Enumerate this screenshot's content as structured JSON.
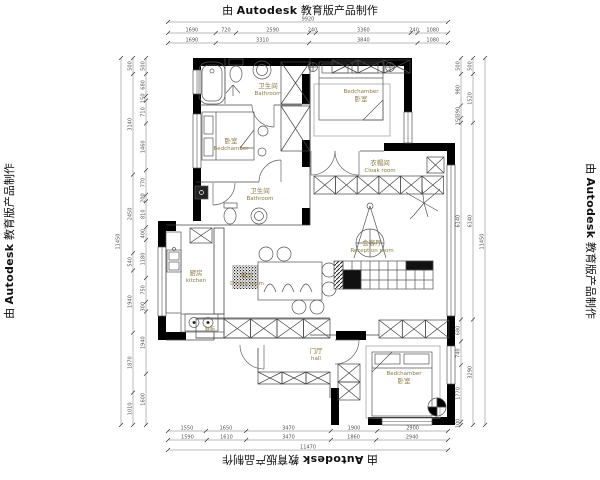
{
  "watermark": {
    "prefix": "由",
    "brand": "Autodesk",
    "suffix": "教育版产品制作"
  },
  "colors": {
    "label": "#8a7a40",
    "wall": "#000000",
    "line": "#444444",
    "dim": "#555555"
  },
  "rooms": {
    "bathroom_top": {
      "zh": "卫生间",
      "en": "Bathroom"
    },
    "bedroom_right": {
      "en": "Bedchamber",
      "zh": "卧室"
    },
    "bedroom_left": {
      "zh": "卧室",
      "en": "Bedchamber"
    },
    "cloak": {
      "zh": "衣帽间",
      "en": "Cloak room"
    },
    "bathroom_mid": {
      "zh": "卫生间",
      "en": "Bathroom"
    },
    "kitchen": {
      "zh": "厨房",
      "en": "kitchen"
    },
    "dining": {
      "zh": "餐厅",
      "en": "Dining room"
    },
    "reception": {
      "zh": "会客厅",
      "en": "Reception room"
    },
    "hall": {
      "zh": "门厅",
      "en": "hall"
    },
    "bedroom_bottom": {
      "en": "Bedchamber",
      "zh": "卧室"
    },
    "shoe_cabinet": {
      "zh": "鞋柜"
    }
  },
  "dims": {
    "top_total": [
      "9920"
    ],
    "top_row1": [
      "1690",
      "720",
      "2590",
      "240",
      "3360",
      "240",
      "1080"
    ],
    "top_row2": [
      "1690",
      "3310",
      "3840",
      "1080"
    ],
    "bottom_row1": [
      "1550",
      "1650",
      "3470",
      "1900",
      "2900"
    ],
    "bottom_row2": [
      "1590",
      "1610",
      "3470",
      "1860",
      "2940"
    ],
    "bottom_total": [
      "11470"
    ],
    "left_total": [
      "11450"
    ],
    "left_outer": [
      "500",
      "3140",
      "2450",
      "540",
      "1940",
      "1870",
      "1010"
    ],
    "left_inner": [
      "500",
      "680",
      "150",
      "710",
      "1460",
      "770",
      "200",
      "810",
      "400",
      "1180",
      "750",
      "300",
      "1940",
      "1600"
    ],
    "right_inner": [
      "500",
      "980",
      "390",
      "150",
      "6140",
      "680",
      "740",
      "1770",
      "100"
    ],
    "right_outer": [
      "500",
      "1520",
      "6140",
      "3290"
    ],
    "right_total": [
      "11450"
    ]
  }
}
